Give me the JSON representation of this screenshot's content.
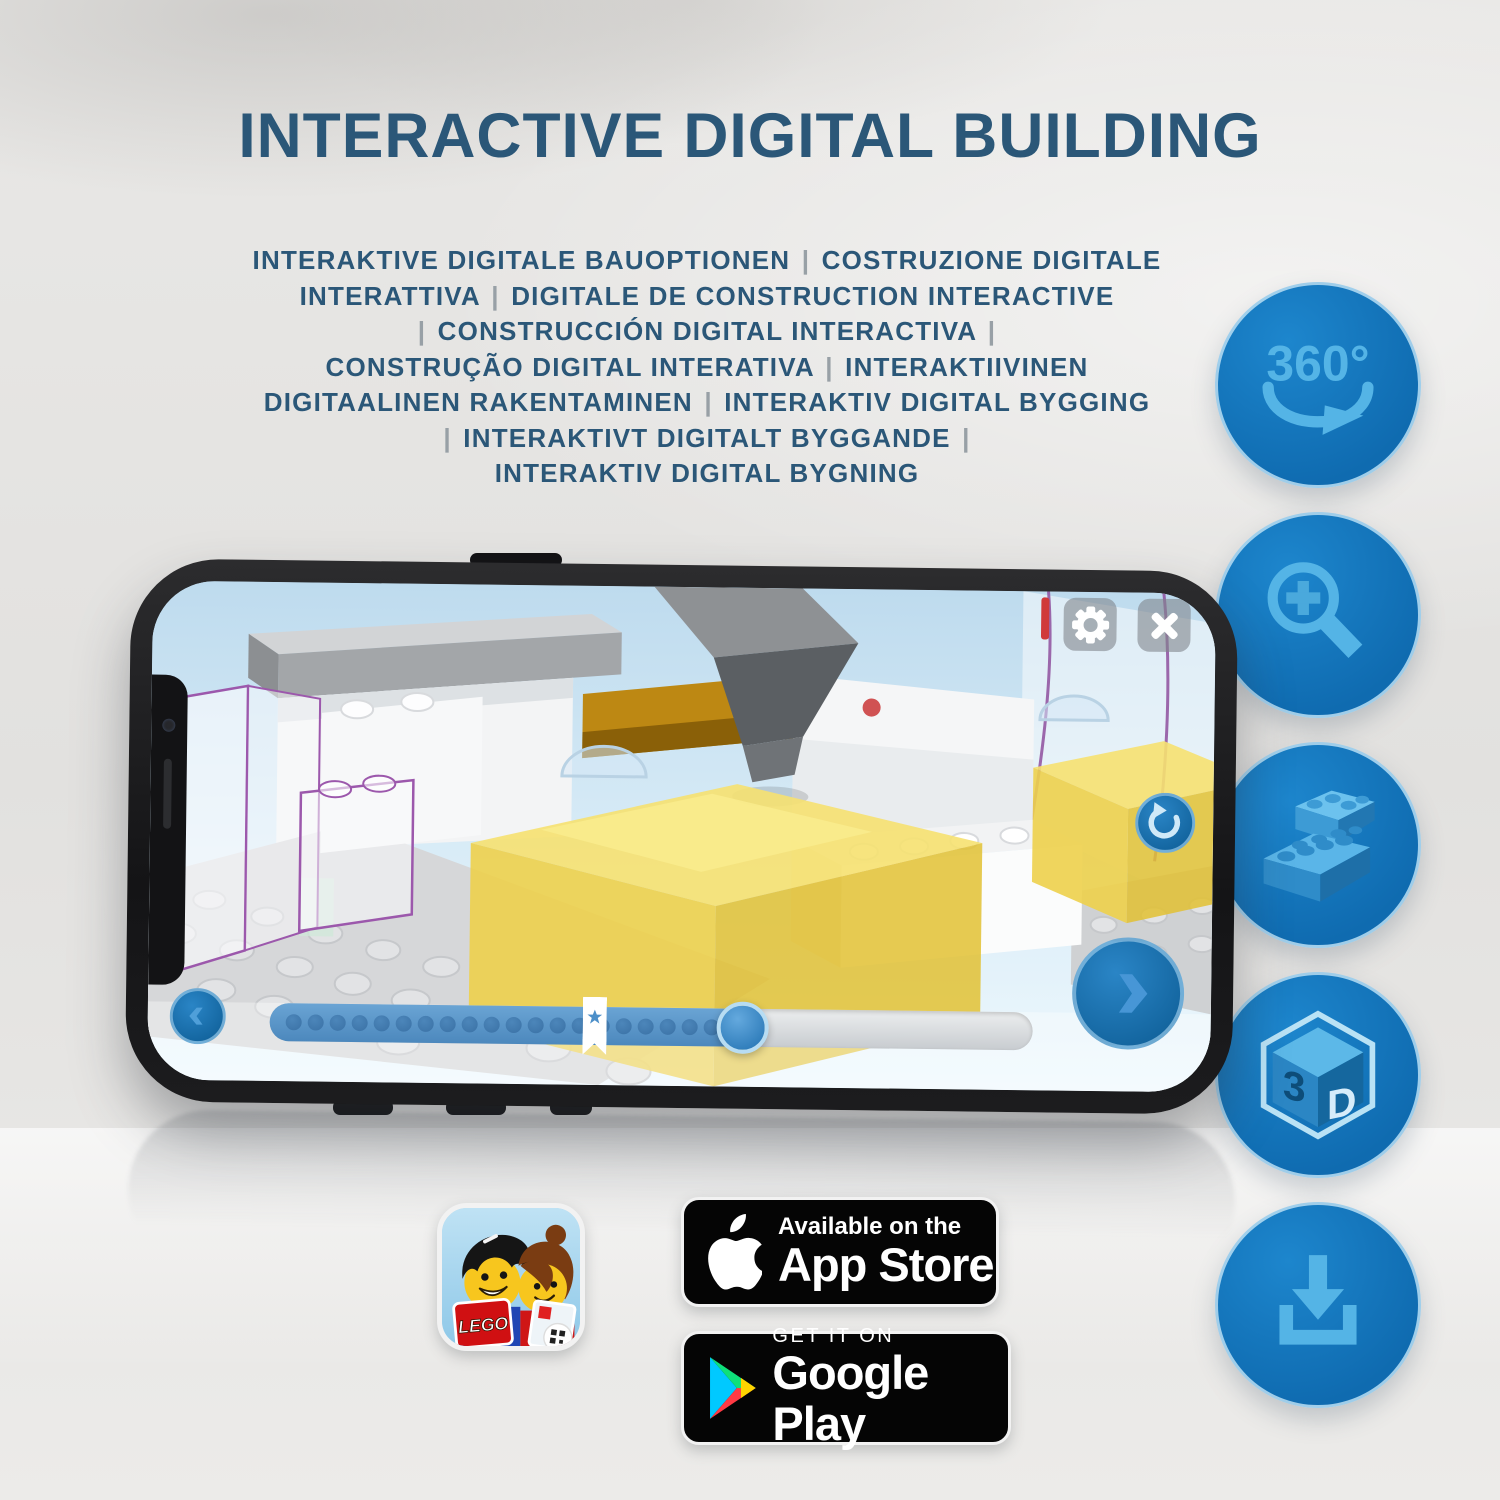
{
  "title": "INTERACTIVE DIGITAL BUILDING",
  "subtitle_lines": [
    "INTERAKTIVE DIGITALE BAUOPTIONEN | COSTRUZIONE DIGITALE",
    "INTERATTIVA | DIGITALE DE CONSTRUCTION INTERACTIVE",
    "| CONSTRUCCIÓN DIGITAL INTERACTIVA |",
    "CONSTRUÇÃO DIGITAL INTERATIVA | INTERAKTIIVINEN",
    "DIGITAALINEN RAKENTAMINEN | INTERAKTIV DIGITAL BYGGING",
    "| INTERAKTIVT DIGITALT BYGGANDE |",
    "INTERAKTIV DIGITAL BYGNING"
  ],
  "features": {
    "items": [
      {
        "name": "360-rotation",
        "label": "360°"
      },
      {
        "name": "zoom-in"
      },
      {
        "name": "brick-building"
      },
      {
        "name": "3d-view",
        "face_left": "3",
        "face_right": "D"
      },
      {
        "name": "download"
      }
    ]
  },
  "app": {
    "progress": {
      "dot_count": 20,
      "filled_percent": 62
    }
  },
  "badges": {
    "lego_logo": "LEGO",
    "app_store": {
      "tagline": "Available on the",
      "name": "App Store"
    },
    "google_play": {
      "tagline": "GET IT ON",
      "name": "Google Play"
    }
  },
  "colors": {
    "title_blue": "#2b5778",
    "feature_circle_blue": "#1377bd",
    "glyph_blue": "#54b4e6",
    "brick_yellow": "#f0d23e",
    "ghost_outline_purple": "#9c58ac",
    "progress_fill_blue": "#5b97cb"
  }
}
